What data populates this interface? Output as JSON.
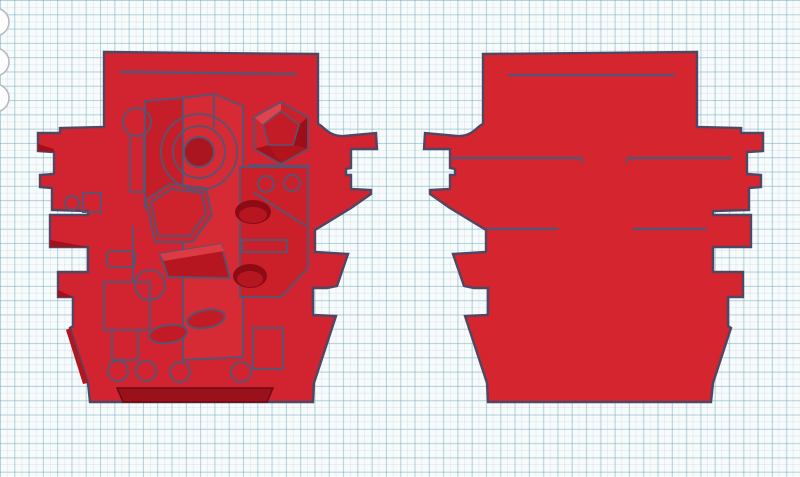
{
  "canvas": {
    "background_color": "#f8fbfc",
    "grid_minor_color": "#e8f1f4",
    "grid_major_color": "#c7e1e9",
    "grid_minor_spacing_px": 7.15,
    "grid_major_spacing_px": 14.3
  },
  "colors": {
    "body_red": "#d12430",
    "body_red_right": "#d5252f",
    "red_light": "#d62b34",
    "red_lighter": "#dd3b44",
    "red_dark": "#b5161f",
    "red_darker": "#9b1119",
    "red_deep": "#8d0b14",
    "outline": "#4f4763",
    "line": "#5c5270",
    "tool_stroke": "#b4bac3",
    "tool_fill": "#fdfdfe"
  },
  "edge_icons": {
    "cx": -5,
    "r": 14,
    "cy": [
      22,
      62,
      98
    ]
  },
  "outline_path": "M104,52 L318,54 L318,124 C323,125 328,137 344,136 L376,133 L377,149 L351,149 L351,168 L346,169 L346,175 L351,175 L351,189 L371,190 L371,194 L351,208 L315,230 L315,252 L348,254 L337,286 L327,288 L313,288 L313,315 L336,316 L314,383 L313,402 L90,402 L88,383 L70,328 L73,326 L73,297 L58,297 L58,272 L88,272 L88,247 L50,247 L50,215 L88,215 L88,211 L52,210 L52,188 L40,187 L40,175 L54,174 L54,152 L38,151 L38,133 L60,133 L60,128 L104,127 Z",
  "mirror_transform": "translate(801,0) scale(-1,1)",
  "left_part": {
    "elements": [
      {
        "t": "path",
        "d": "@outline",
        "fill": "#d12430",
        "stroke": "#4f4763",
        "sw": 2.4,
        "name": "part-outline"
      },
      {
        "t": "polygon",
        "pts": "183,98 214,94 243,106 243,357 183,360",
        "fill": "#d62b34",
        "name": "center-slab"
      },
      {
        "t": "polygon",
        "pts": "145,101 183,98 183,205 145,208",
        "fill": "#c51e28",
        "name": "left-facet-panel"
      },
      {
        "t": "polygon",
        "pts": "240,167 308,167 308,268 281,297 240,297",
        "fill": "#cb202a",
        "name": "right-plate"
      },
      {
        "t": "line",
        "x1": 253,
        "y1": 192,
        "x2": 306,
        "y2": 226,
        "name": "plate-fold-line"
      },
      {
        "t": "polygon",
        "pts": "146,200 170,184 206,188 212,215 193,242 155,242",
        "fill": "#ce222c",
        "name": "hex-boss-outer"
      },
      {
        "t": "polygon",
        "pts": "151,202 172,189 202,193 206,214 190,236 158,236",
        "name": "hex-boss-inner"
      },
      {
        "t": "polygon",
        "pts": "160,254 221,244 230,278 168,277",
        "fill": "#b5161f",
        "name": "wedge-block"
      },
      {
        "t": "polygon",
        "pts": "160,254 221,244 224,251 164,261",
        "fill": "#dd3b44",
        "stroke": "none",
        "name": "wedge-highlight"
      },
      {
        "t": "polygon",
        "pts": "281,102 308,117 308,149 281,164 254,149 254,117",
        "fill": "#c11a24",
        "stroke": "none",
        "name": "icosa-base"
      },
      {
        "t": "polygon",
        "pts": "254,117 281,102 281,111 263,125",
        "fill": "#e0434c",
        "stroke": "none",
        "name": "icosa-facet"
      },
      {
        "t": "polygon",
        "pts": "281,102 308,117 299,125 281,111",
        "fill": "#c92129",
        "stroke": "none",
        "name": "icosa-facet"
      },
      {
        "t": "polygon",
        "pts": "308,117 308,149 293,145 299,125",
        "fill": "#9d0f18",
        "stroke": "none",
        "name": "icosa-facet"
      },
      {
        "t": "polygon",
        "pts": "308,149 281,164 269,145 293,145",
        "fill": "#b2141d",
        "stroke": "none",
        "name": "icosa-facet"
      },
      {
        "t": "polygon",
        "pts": "254,149 254,117 263,125 269,145",
        "fill": "#cd2630",
        "stroke": "none",
        "name": "icosa-facet"
      },
      {
        "t": "polygon",
        "pts": "281,164 254,149 269,145",
        "fill": "#a81019",
        "stroke": "none",
        "name": "icosa-facet"
      },
      {
        "t": "polygon",
        "pts": "281,111 299,125 293,145 269,145 263,125",
        "fill": "#c41c26",
        "sw": 1.6,
        "name": "icosa-pentagon"
      },
      {
        "t": "polygon",
        "pts": "281,102 308,117 308,149 281,164 254,149 254,117",
        "sw": 1.8,
        "name": "icosa-outline"
      },
      {
        "t": "line",
        "x1": 248,
        "y1": 165,
        "x2": 310,
        "y2": 166,
        "name": "plate-top-line"
      },
      {
        "t": "line",
        "x1": 130,
        "y1": 136,
        "x2": 130,
        "y2": 192,
        "name": "stem-line"
      },
      {
        "t": "line",
        "x1": 144,
        "y1": 136,
        "x2": 144,
        "y2": 192,
        "name": "stem-line"
      },
      {
        "t": "line",
        "x1": 130,
        "y1": 192,
        "x2": 144,
        "y2": 192,
        "name": "stem-line"
      },
      {
        "t": "circle",
        "cx": 137,
        "cy": 122,
        "r": 14,
        "name": "periscope-circle"
      },
      {
        "t": "circle",
        "cx": 199,
        "cy": 152,
        "r": 38,
        "name": "hatch-ring-outer"
      },
      {
        "t": "circle",
        "cx": 199,
        "cy": 152,
        "r": 26,
        "name": "hatch-ring-middle"
      },
      {
        "t": "circle",
        "cx": 199,
        "cy": 152,
        "r": 15,
        "fill": "#ab1520",
        "name": "hatch-core"
      },
      {
        "t": "circle",
        "cx": 266,
        "cy": 184,
        "r": 8,
        "name": "small-ring"
      },
      {
        "t": "circle",
        "cx": 292,
        "cy": 183,
        "r": 8,
        "name": "small-ring"
      },
      {
        "t": "circle",
        "cx": 72,
        "cy": 203,
        "r": 7,
        "name": "small-ring"
      },
      {
        "t": "ellipse",
        "cx": 253,
        "cy": 212,
        "rx": 18,
        "ry": 12,
        "fill": "#8d0b14",
        "stroke": "none",
        "name": "recessed-oval"
      },
      {
        "t": "ellipse",
        "cx": 253,
        "cy": 215,
        "rx": 14,
        "ry": 8,
        "fill": "#b5161f",
        "stroke": "none",
        "name": "recessed-oval-floor"
      },
      {
        "t": "ellipse",
        "cx": 250,
        "cy": 276,
        "rx": 17,
        "ry": 12,
        "fill": "#8d0b14",
        "stroke": "none",
        "name": "recessed-oval"
      },
      {
        "t": "ellipse",
        "cx": 250,
        "cy": 279,
        "rx": 13,
        "ry": 8,
        "fill": "#b5161f",
        "stroke": "none",
        "name": "recessed-oval-floor"
      },
      {
        "t": "rect",
        "x": 242,
        "y": 240,
        "w": 45,
        "h": 12,
        "name": "slot-rect"
      },
      {
        "t": "rect",
        "x": 104,
        "y": 282,
        "w": 46,
        "h": 48,
        "name": "panel-rect"
      },
      {
        "t": "rect",
        "x": 112,
        "y": 330,
        "w": 26,
        "h": 30,
        "name": "panel-rect"
      },
      {
        "t": "rect",
        "x": 107,
        "y": 251,
        "w": 28,
        "h": 16,
        "rx": 4,
        "name": "rounded-block"
      },
      {
        "t": "rect",
        "x": 83,
        "y": 193,
        "w": 18,
        "h": 19,
        "name": "small-rect"
      },
      {
        "t": "rect",
        "x": 253,
        "y": 328,
        "w": 30,
        "h": 41,
        "name": "panel-rect"
      },
      {
        "t": "line",
        "x1": 133,
        "y1": 226,
        "x2": 133,
        "y2": 282,
        "name": "slab-edge-line"
      },
      {
        "t": "line",
        "x1": 214,
        "y1": 95,
        "x2": 214,
        "y2": 128,
        "name": "slab-edge-line"
      },
      {
        "t": "ellipse",
        "cx": 206,
        "cy": 319,
        "rx": 19,
        "ry": 9,
        "tr": "rotate(-10 206 319)",
        "fill": "#c21b25",
        "name": "oval-pad"
      },
      {
        "t": "ellipse",
        "cx": 168,
        "cy": 334,
        "rx": 19,
        "ry": 9,
        "tr": "rotate(-8 168 334)",
        "fill": "#c21b25",
        "name": "oval-pad"
      },
      {
        "t": "circle",
        "cx": 150,
        "cy": 285,
        "r": 15,
        "name": "round-port"
      },
      {
        "t": "circle",
        "cx": 118,
        "cy": 371,
        "r": 10,
        "name": "bottom-ring"
      },
      {
        "t": "circle",
        "cx": 146,
        "cy": 371,
        "r": 10,
        "name": "bottom-ring"
      },
      {
        "t": "circle",
        "cx": 180,
        "cy": 372,
        "r": 10,
        "name": "bottom-ring"
      },
      {
        "t": "circle",
        "cx": 241,
        "cy": 372,
        "r": 10,
        "name": "bottom-ring"
      },
      {
        "t": "line",
        "x1": 120,
        "y1": 72,
        "x2": 297,
        "y2": 74,
        "sw": 2.6,
        "name": "top-score-line"
      },
      {
        "t": "polygon",
        "pts": "50,240 88,247 50,247",
        "fill": "#a21019",
        "stroke": "none",
        "name": "tab-shadow"
      },
      {
        "t": "polygon",
        "pts": "58,290 73,297 58,297",
        "fill": "#a21019",
        "stroke": "none",
        "name": "tab-shadow"
      },
      {
        "t": "polygon",
        "pts": "38,144 54,149 54,152 38,151",
        "fill": "#a21019",
        "stroke": "none",
        "name": "tab-shadow"
      },
      {
        "t": "polygon",
        "pts": "66,330 70,328 88,383 83,384",
        "fill": "#b01620",
        "stroke": "none",
        "name": "edge-shadow"
      },
      {
        "t": "polygon",
        "pts": "117,388 273,388 267,402 123,402",
        "fill": "#9b1119",
        "stroke": "#6b0a12",
        "sw": 1.5,
        "name": "recessed-bar"
      }
    ]
  },
  "right_part": {
    "elements": [
      {
        "t": "path",
        "d": "@outline",
        "tr": "@mirror",
        "fill": "#d5252f",
        "stroke": "#4f4763",
        "sw": 2.4,
        "name": "part-outline"
      },
      {
        "t": "line",
        "x1": 508,
        "y1": 75,
        "x2": 675,
        "y2": 75,
        "sw": 2.6,
        "name": "score-line"
      },
      {
        "t": "line",
        "x1": 452,
        "y1": 158,
        "x2": 582,
        "y2": 158,
        "sw": 2.6,
        "name": "score-line"
      },
      {
        "t": "line",
        "x1": 627,
        "y1": 158,
        "x2": 732,
        "y2": 158,
        "sw": 2.6,
        "name": "score-line"
      },
      {
        "t": "line",
        "x1": 487,
        "y1": 229,
        "x2": 558,
        "y2": 229,
        "sw": 2.6,
        "name": "score-line"
      },
      {
        "t": "line",
        "x1": 633,
        "y1": 229,
        "x2": 707,
        "y2": 229,
        "sw": 2.6,
        "name": "score-line"
      },
      {
        "t": "line",
        "x1": 582,
        "y1": 158,
        "x2": 582,
        "y2": 163,
        "sw": 2,
        "name": "score-tick"
      },
      {
        "t": "line",
        "x1": 627,
        "y1": 158,
        "x2": 627,
        "y2": 163,
        "sw": 2,
        "name": "score-tick"
      }
    ]
  }
}
